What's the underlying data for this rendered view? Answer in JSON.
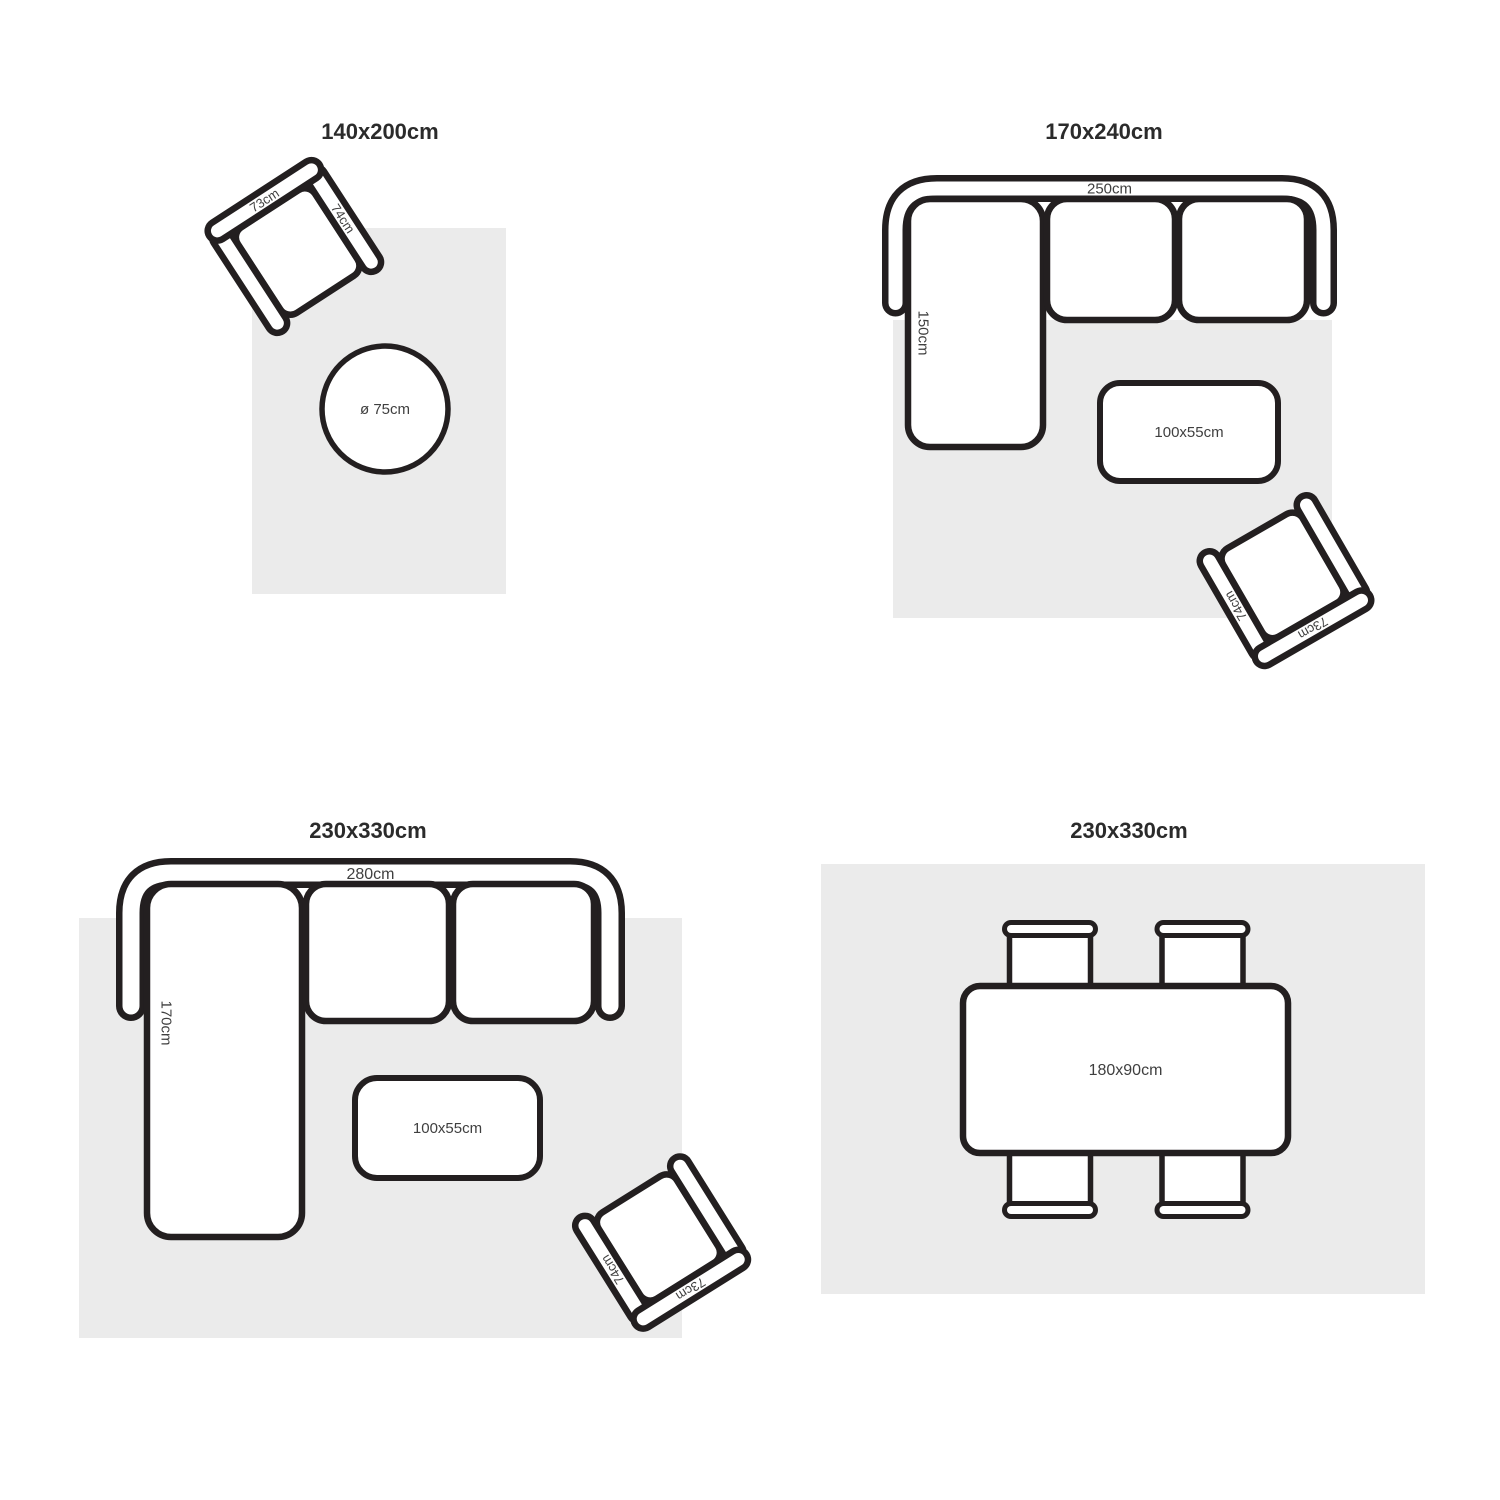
{
  "colors": {
    "background": "#ffffff",
    "outline": "#231f20",
    "rug": "#ebebeb",
    "label_text": "#3f3f3f",
    "title_text": "#2b2b2b"
  },
  "quadrants": {
    "q1": {
      "title": "140x200cm",
      "armchair": {
        "back": "73cm",
        "arm": "74cm"
      },
      "round_table": {
        "label": "ø 75cm"
      }
    },
    "q2": {
      "title": "170x240cm",
      "sofa": {
        "width": "250cm",
        "depth": "150cm"
      },
      "coffee_table": {
        "label": "100x55cm"
      },
      "armchair": {
        "back": "73cm",
        "arm": "74cm"
      }
    },
    "q3": {
      "title": "230x330cm",
      "sofa": {
        "width": "280cm",
        "depth": "170cm"
      },
      "coffee_table": {
        "label": "100x55cm"
      },
      "armchair": {
        "back": "73cm",
        "arm": "74cm"
      }
    },
    "q4": {
      "title": "230x330cm",
      "dining_table": {
        "label": "180x90cm"
      }
    }
  }
}
